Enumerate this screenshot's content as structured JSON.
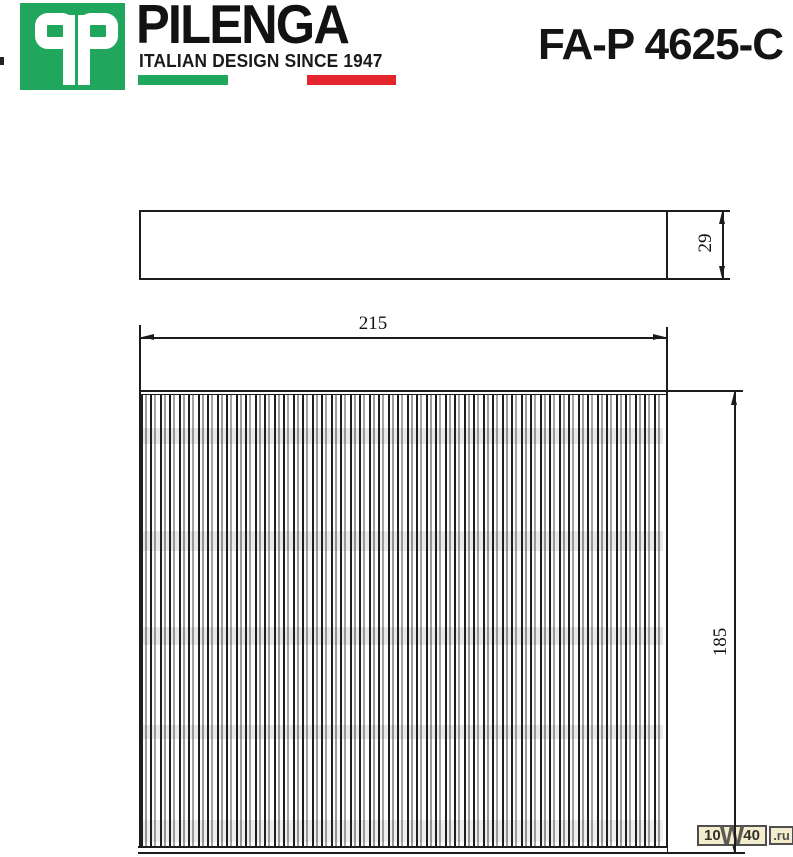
{
  "header": {
    "logo_letters": "qp",
    "brand": "PILENGA",
    "tagline": "ITALIAN DESIGN SINCE 1947",
    "part_number": "FA-P 4625-C",
    "colors": {
      "logo_green": "#21A75D",
      "flag_green": "#21A75D",
      "flag_red": "#E5252C"
    }
  },
  "drawing": {
    "type": "technical-drawing",
    "subject": "cabin air filter",
    "dimensions": {
      "width_mm": "215",
      "height_mm": "185",
      "depth_mm": "29"
    }
  },
  "watermark": {
    "pre": "10",
    "w": "W",
    "post": "40",
    "suffix": ".ru"
  }
}
